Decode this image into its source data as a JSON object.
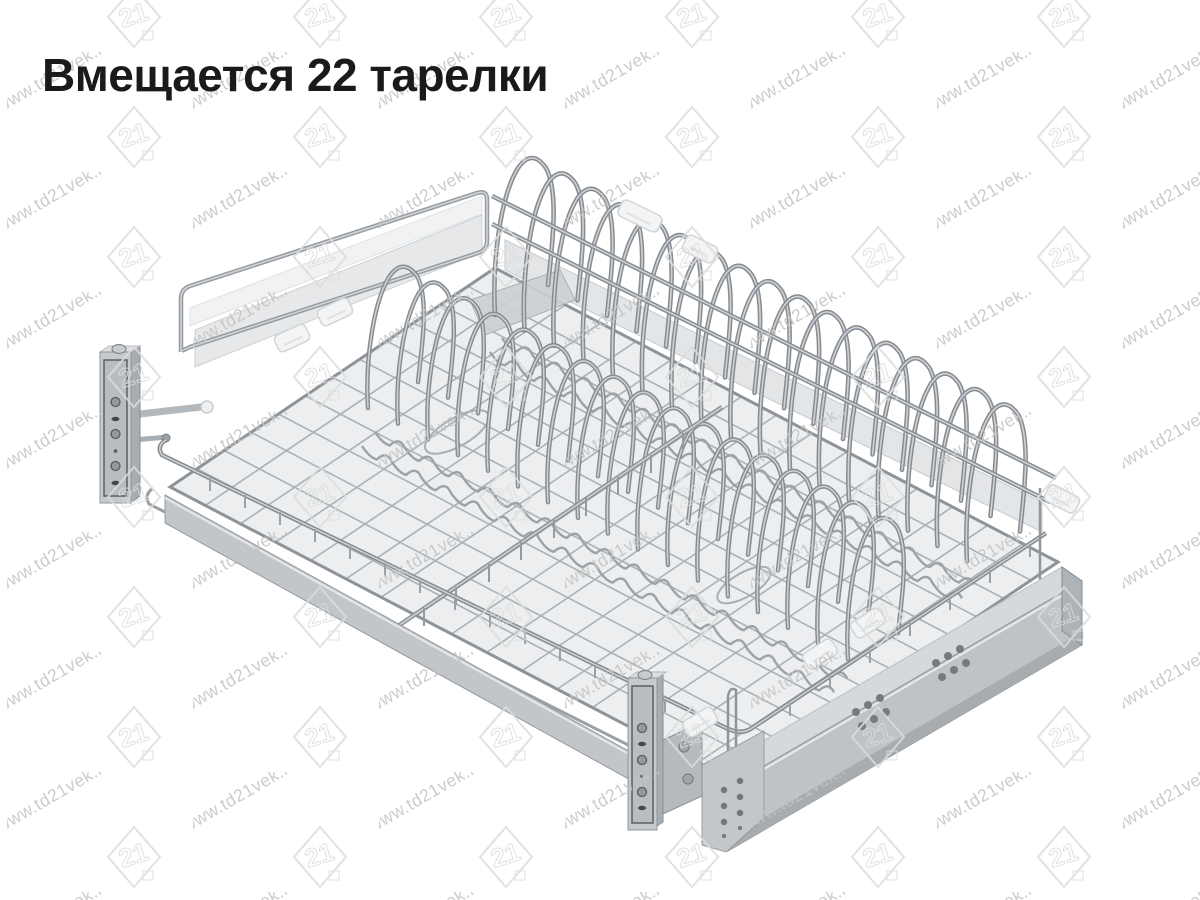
{
  "page": {
    "background": "#ffffff"
  },
  "header": {
    "title": "Вмещается 22 тарелки",
    "title_color": "#1a1a1a"
  },
  "watermark": {
    "url_text": "www.td21vek.ru",
    "logo_text": "21",
    "text_color": "#c3c3c3",
    "logo_color": "#dcdcdc"
  },
  "illustration": {
    "name": "pull-out-dish-drying-rack",
    "plate_capacity": "22",
    "colors": {
      "wire_dark": "#868c92",
      "wire_light": "#ced2d5",
      "wire_mesh": "#abb1b6",
      "panel_light": "#e6e8ea",
      "panel_lighter": "#f1f2f3",
      "deck_fill": "#eceeef",
      "slide_top": "#d6d9db",
      "slide_side": "#bfc3c7",
      "slide_band": "#a7acb0",
      "bracket_face": "#c6cacd",
      "bracket_inset": "#b9bdc1",
      "hole_dark": "#44484c",
      "clip_white": "#f3f4f5"
    }
  }
}
